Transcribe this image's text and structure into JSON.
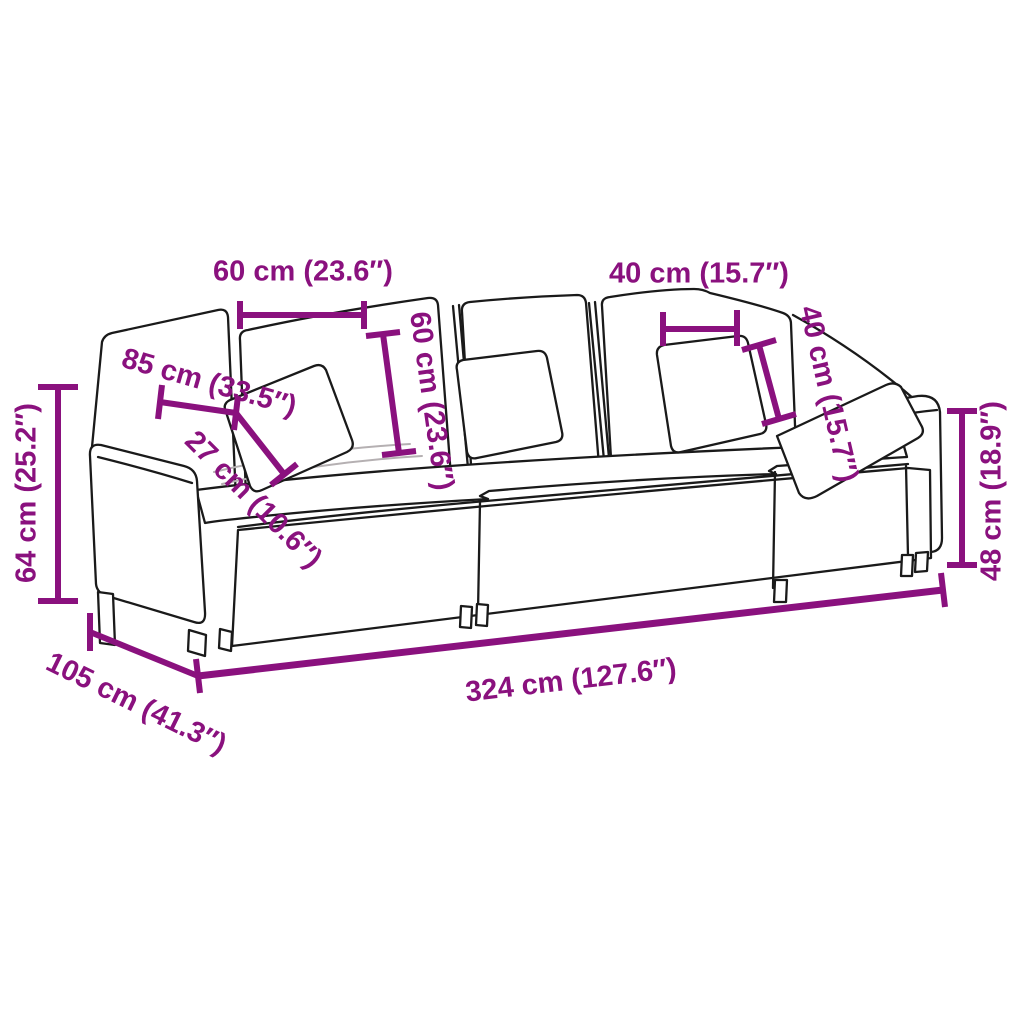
{
  "diagram": {
    "kind": "product-dimension-diagram",
    "subject": "3-seater modular sofa line drawing with throw pillows",
    "accent_color": "#8a117e",
    "line_color": "#1a1a1a",
    "background_color": "#ffffff"
  },
  "dimensions": {
    "back_cushion_width": "60 cm (23.6″)",
    "back_cushion_height": "60 cm (23.6″)",
    "pillow_width": "40 cm (15.7″)",
    "pillow_height": "40 cm (15.7″)",
    "seat_width": "85 cm (33.5″)",
    "seat_cushion_thickness": "27 cm (10.6″)",
    "total_height": "64 cm (25.2″)",
    "armrest_height": "48 cm (18.9″)",
    "total_width": "324 cm (127.6″)",
    "total_depth": "105 cm (41.3″)"
  }
}
